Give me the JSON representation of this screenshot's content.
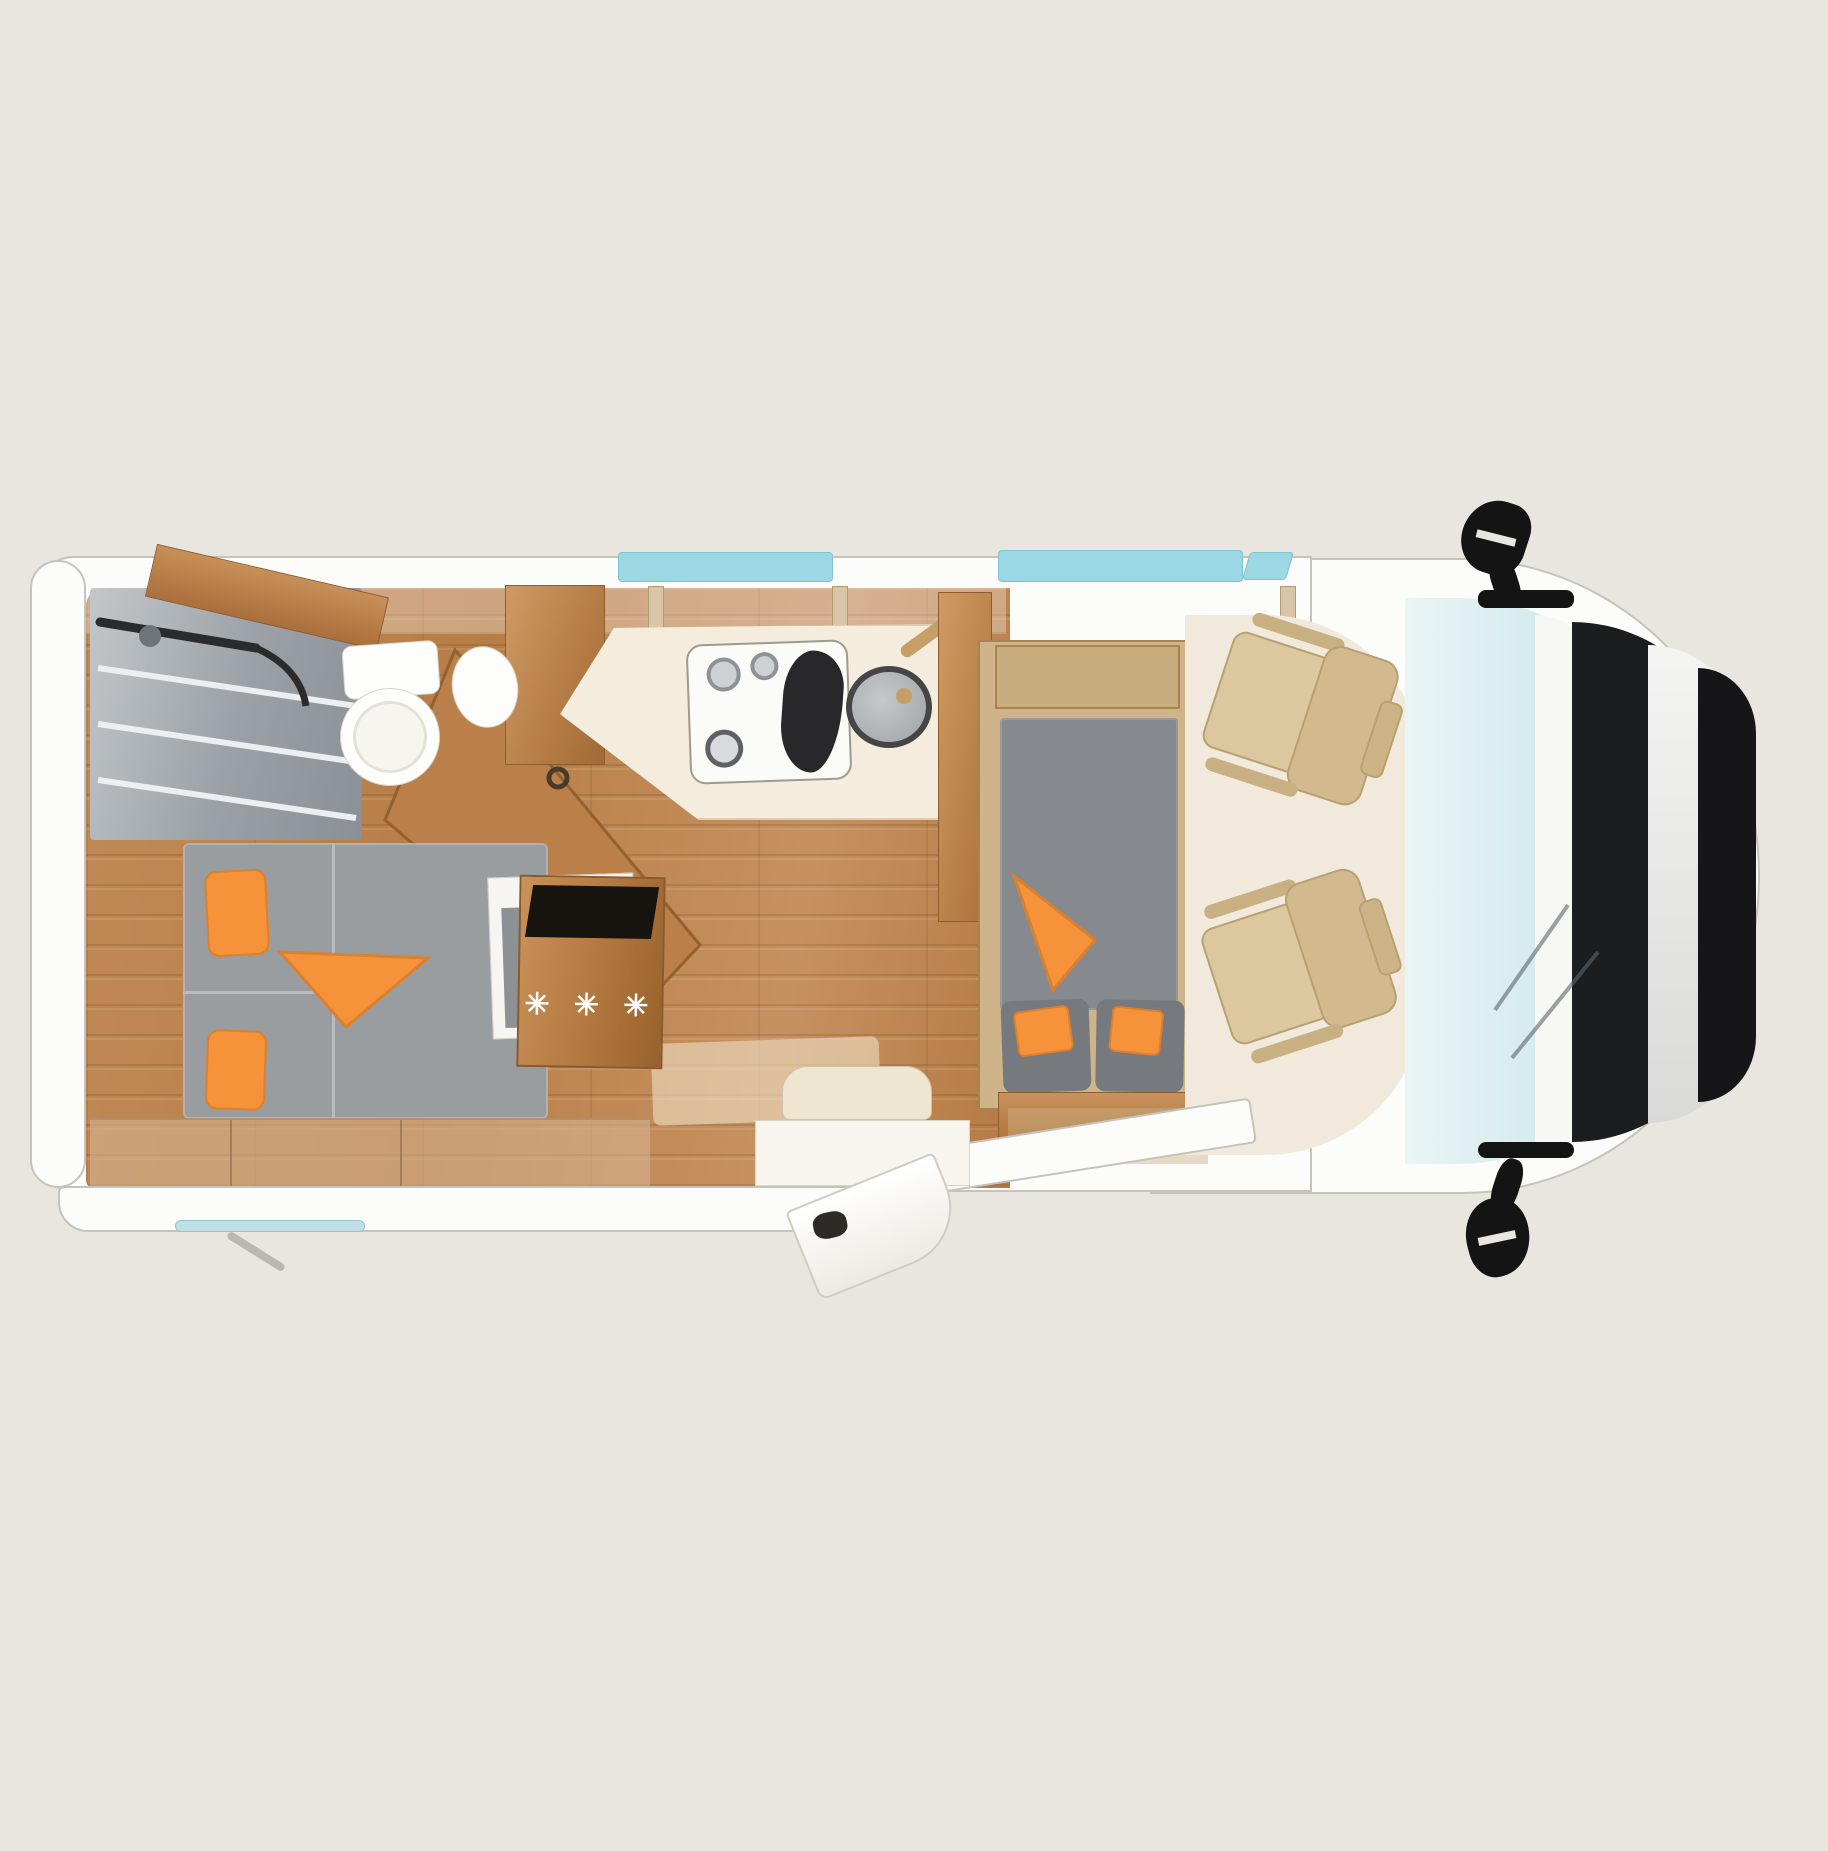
{
  "meta": {
    "title": "Motorhome floor plan - top view",
    "view": "top-down cutaway"
  },
  "colors": {
    "bg": "#e9e6df",
    "body": "#fcfcfa",
    "outline": "#c6c3bb",
    "window": "#9cd8e4",
    "windshield": "#cfe9ec",
    "counter": "#f4ecdc",
    "mattress": "#999da0",
    "table": "#86898d",
    "cushion": "#76797e",
    "orange": "#f5923a",
    "tan": "#cfb489"
  },
  "fridge": {
    "label": "✳ ✳ ✳"
  },
  "inventory": {
    "rooms": [
      "shower",
      "bathroom",
      "rear-bedroom",
      "kitchen",
      "dinette-lounge",
      "driver-cab"
    ],
    "furniture": [
      "double-bed-with-orange-pillows",
      "wardrobe-with-angled-door",
      "toilet",
      "washbasin",
      "kitchen-counter",
      "two-burner-stove",
      "round-sink",
      "refrigerator",
      "dinette-table-bed",
      "bench-seat-with-cushions",
      "swivel-passenger-seat",
      "swivel-driver-seat",
      "entry-step",
      "open-entry-door",
      "awning-rail",
      "side-mirror-top",
      "side-mirror-bottom"
    ],
    "window_count": 2,
    "cab_seat_count": 2
  }
}
